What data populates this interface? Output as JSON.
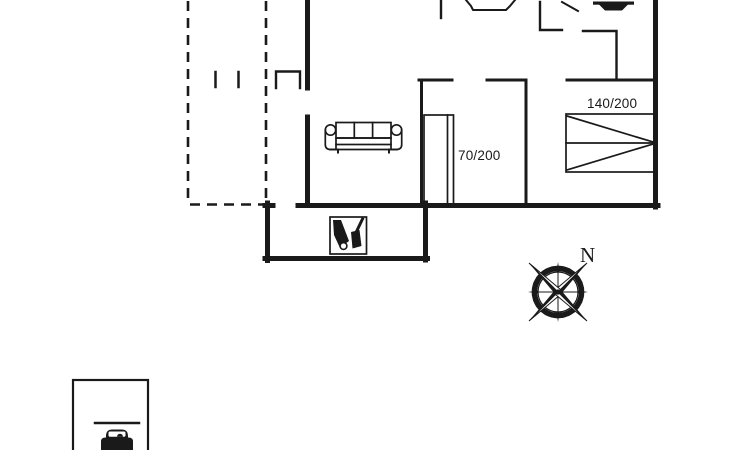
{
  "meta": {
    "type": "holiday-house-floor-plan",
    "background_color": "#ffffff",
    "ink_color": "#1a1a1a"
  },
  "labels": {
    "bed_single_size": "70/200",
    "bed_double_size": "140/200",
    "compass_north": "N"
  },
  "icons": [
    "sofa-icon",
    "single-bed-icon",
    "double-bed-icon",
    "sink-icon",
    "toilet-icon",
    "door-swing-line",
    "garden-tools-icon",
    "compass-rose-icon",
    "car-icon"
  ],
  "areas": [
    "terrace-dashed-outline",
    "living-room",
    "bedroom-single",
    "bedroom-double",
    "bathroom",
    "tool-shed",
    "carport"
  ]
}
